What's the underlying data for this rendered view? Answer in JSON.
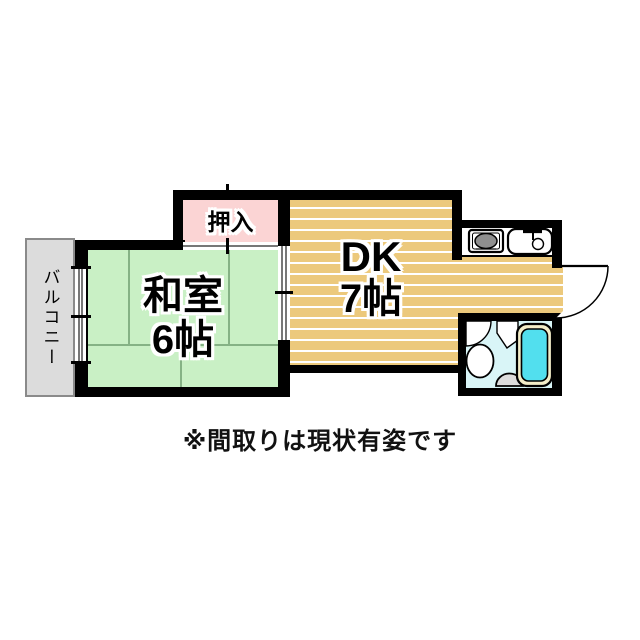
{
  "plan": {
    "type": "apartment-floorplan",
    "rooms": {
      "balcony": {
        "name": "バルコニー"
      },
      "washitsu": {
        "name": "和室",
        "size": "6帖"
      },
      "oshiire": {
        "name": "押入"
      },
      "dk": {
        "name": "DK",
        "size": "7帖"
      }
    },
    "fixtures": [
      {
        "id": "stove",
        "name": "gas-stove-icon"
      },
      {
        "id": "sink",
        "name": "kitchen-sink-icon"
      },
      {
        "id": "toilet",
        "name": "toilet-icon"
      },
      {
        "id": "washbasin",
        "name": "wash-basin-icon"
      },
      {
        "id": "bathtub",
        "name": "bathtub-icon"
      },
      {
        "id": "entrance-door",
        "name": "entrance-door-swing-icon"
      },
      {
        "id": "bathroom-door",
        "name": "bathroom-door-swing-icon"
      },
      {
        "id": "window",
        "name": "balcony-sliding-window"
      },
      {
        "id": "fusuma",
        "name": "room-sliding-door"
      },
      {
        "id": "oshiire-door",
        "name": "closet-sliding-door"
      }
    ],
    "note": "※間取りは現状有姿です"
  },
  "colors": {
    "wall": "#000000",
    "tatami": "#c9f0c5",
    "tatami_line": "#85b285",
    "dk_floor": "#ecc97c",
    "closet": "#fbd4d4",
    "balcony": "#dcdcdc",
    "balcony_border": "#8a8a8a",
    "bath_bg": "#d9f5f7",
    "tub": "#52dfee",
    "tub_rim": "#f3edc8",
    "stove_gray": "#8f8f8f",
    "basin_gray": "#dcdcdc"
  }
}
